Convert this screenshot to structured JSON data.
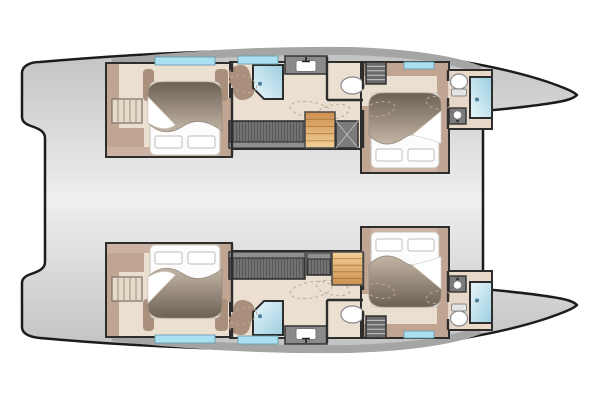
{
  "canvas": {
    "width": 600,
    "height": 400
  },
  "plan": {
    "type": "catamaran-accommodation-plan",
    "bow_direction": "right",
    "hulls": [
      {
        "id": "hull-port",
        "side": "port",
        "mirrored": true
      },
      {
        "id": "hull-starboard",
        "side": "starboard",
        "mirrored": false
      }
    ],
    "summary": {
      "cabins": 4,
      "bathrooms": 4,
      "showers": 4,
      "berths": 4
    },
    "fixtures_shared": [
      {
        "name": "aft-cabin-floor",
        "type": "room",
        "rect": [
          106,
          243,
          126,
          94
        ],
        "fill": "cabin_floor"
      },
      {
        "name": "corridor-floor",
        "type": "room",
        "rect": [
          230,
          251,
          134,
          87
        ],
        "fill": "cabin_floor"
      },
      {
        "name": "forward-cabin-floor",
        "type": "room",
        "rect": [
          361,
          227,
          88,
          111
        ],
        "fill": "cabin_floor"
      },
      {
        "name": "forward-bathroom-floor",
        "type": "room",
        "rect": [
          447,
          271,
          45,
          59
        ],
        "fill": "bath_floor"
      },
      {
        "name": "aft-cabin-wardrobe",
        "type": "band",
        "rect": [
          107,
          244,
          37,
          28
        ],
        "fill": "joinery_taupe"
      },
      {
        "name": "aft-cabin-side-shelf",
        "type": "band",
        "rect": [
          107,
          244,
          12,
          92
        ],
        "fill": "joinery_taupe"
      },
      {
        "name": "aft-cabin-head-strip",
        "type": "band",
        "rect": [
          107,
          244,
          124,
          9
        ],
        "fill": "joinery_taupe_light"
      },
      {
        "name": "aft-cabin-side-right",
        "type": "band",
        "rect": [
          220,
          244,
          11,
          58
        ],
        "fill": "joinery_taupe"
      },
      {
        "name": "aft-bed-flank-left",
        "type": "band",
        "rect": [
          143,
          299,
          11,
          32
        ],
        "fill": "joinery_taupe_dark",
        "rx": 4
      },
      {
        "name": "aft-bed-flank-right",
        "type": "band",
        "rect": [
          215,
          299,
          13,
          32
        ],
        "fill": "joinery_taupe_dark",
        "rx": 4
      },
      {
        "name": "aft-double-berth",
        "type": "bed",
        "rect": [
          150,
          245,
          70,
          73
        ],
        "fold": "left"
      },
      {
        "name": "aft-cabin-ladder",
        "type": "hatch-v",
        "rect": [
          112,
          277,
          30,
          24
        ]
      },
      {
        "name": "hull-settee",
        "type": "stripes",
        "rect": [
          229,
          252,
          76,
          27
        ]
      },
      {
        "name": "mid-shower-partition",
        "type": "wedge",
        "rect": [
          231,
          300,
          21,
          35
        ],
        "rot": 16
      },
      {
        "name": "mid-shower",
        "type": "shower",
        "rect": [
          253,
          301,
          30,
          34
        ],
        "corner": "tl"
      },
      {
        "name": "mid-vanity-sink",
        "type": "sink",
        "rect": [
          285,
          326,
          42,
          18
        ]
      },
      {
        "name": "mid-toilet",
        "type": "toilet",
        "rect": [
          341,
          306,
          23,
          17
        ],
        "orient": "h"
      },
      {
        "name": "forward-cabin-head-strip",
        "type": "band",
        "rect": [
          362,
          228,
          86,
          8
        ],
        "fill": "joinery_taupe_light"
      },
      {
        "name": "forward-cabin-side-left",
        "type": "band",
        "rect": [
          362,
          228,
          9,
          66
        ],
        "fill": "joinery_taupe"
      },
      {
        "name": "forward-cabin-side-right",
        "type": "band",
        "rect": [
          437,
          228,
          11,
          100
        ],
        "fill": "joinery_taupe"
      },
      {
        "name": "forward-cabin-foot-band",
        "type": "band",
        "rect": [
          362,
          324,
          86,
          13
        ],
        "fill": "joinery_taupe"
      },
      {
        "name": "forward-double-berth",
        "type": "bed",
        "rect": [
          371,
          232,
          68,
          75
        ],
        "fold": "right"
      },
      {
        "name": "forward-cabin-shelves",
        "type": "hatch-h",
        "rect": [
          366,
          316,
          20,
          22
        ]
      },
      {
        "name": "forward-sink",
        "type": "sink2",
        "rect": [
          449,
          276,
          17,
          16
        ]
      },
      {
        "name": "forward-toilet",
        "type": "toilet",
        "rect": [
          450,
          304,
          18,
          22
        ],
        "orient": "v"
      },
      {
        "name": "forward-shower",
        "type": "shower",
        "rect": [
          470,
          282,
          22,
          41
        ]
      },
      {
        "name": "hull-window-aft",
        "type": "window",
        "rect": [
          155,
          335,
          60,
          8
        ]
      },
      {
        "name": "hull-window-mid",
        "type": "window",
        "rect": [
          238,
          336,
          40,
          8
        ]
      },
      {
        "name": "hull-window-forward",
        "type": "window",
        "rect": [
          404,
          331,
          30,
          7
        ]
      },
      {
        "name": "wall-aft-cabin",
        "type": "wall",
        "line": [
          232,
          244,
          232,
          312
        ]
      },
      {
        "name": "wall-aft-cabin-stub",
        "type": "wall",
        "line": [
          232,
          328,
          232,
          337
        ]
      },
      {
        "name": "wall-toilet-left",
        "type": "wall",
        "line": [
          327,
          300,
          327,
          343
        ]
      },
      {
        "name": "wall-toilet-top",
        "type": "wall",
        "line": [
          327,
          300,
          363,
          300
        ]
      },
      {
        "name": "wall-fwd-cabin-aft-1",
        "type": "wall",
        "line": [
          363,
          252,
          363,
          290
        ]
      },
      {
        "name": "wall-fwd-cabin-aft-2",
        "type": "wall",
        "line": [
          363,
          311,
          363,
          337
        ]
      },
      {
        "name": "wall-fwd-cabin-fwd-1",
        "type": "wall",
        "line": [
          448,
          271,
          448,
          302
        ]
      },
      {
        "name": "wall-fwd-cabin-fwd-2",
        "type": "wall",
        "line": [
          448,
          319,
          448,
          330
        ]
      },
      {
        "name": "door-swing-aft-cabin",
        "type": "arc",
        "ell": [
          243,
          316,
          14,
          8,
          -18
        ]
      },
      {
        "name": "door-swing-corridor-a",
        "type": "arc",
        "ell": [
          311,
          290,
          21,
          8,
          -10
        ]
      },
      {
        "name": "door-swing-corridor-b",
        "type": "arc",
        "ell": [
          333,
          288,
          17,
          7,
          12
        ]
      },
      {
        "name": "door-swing-fwd-cabin",
        "type": "arc",
        "ell": [
          380,
          291,
          15,
          7,
          10
        ]
      },
      {
        "name": "door-swing-fwd-bath",
        "type": "arc",
        "ell": [
          438,
          297,
          12,
          6,
          -12
        ]
      }
    ],
    "fixtures_starboard": [
      {
        "name": "hull-locker",
        "type": "stripes",
        "rect": [
          307,
          253,
          24,
          22
        ]
      },
      {
        "name": "companionway-steps",
        "type": "steps",
        "rect": [
          332,
          252,
          31,
          33
        ]
      }
    ],
    "fixtures_port": [
      {
        "name": "companionway-steps",
        "type": "steps",
        "rect": [
          305,
          252,
          30,
          36
        ]
      },
      {
        "name": "technical-hatch",
        "type": "xbox",
        "rect": [
          336,
          252,
          22,
          27
        ]
      }
    ]
  },
  "palette": {
    "background": "#ffffff",
    "outline": "#1c1c1c",
    "deck_edge": "#c2c2c2",
    "deck_center": "#efefef",
    "cabin_floor": "#eadfd1",
    "bath_floor": "#e7d8ca",
    "joinery_taupe": "#c1a593",
    "joinery_taupe_light": "#cbb2a2",
    "joinery_taupe_dark": "#ab8f7d",
    "bedding_white": "#fcfcfc",
    "duvet_light": "#c3b5a6",
    "duvet_dark": "#6c6053",
    "shower_light": "#e8f6fa",
    "shower_dark": "#9ccee0",
    "hull_window_blue": "#abe0f1",
    "window_frame": "#6d9fb0",
    "settee_gray": "#575757",
    "settee_back": "#8f8f8f",
    "settee_stripe": "#9b9b9b",
    "steps_wood_light": "#f3cf96",
    "steps_wood_dark": "#cd8f4e",
    "wall_outline": "#2d2d2d",
    "fixture_white": "#ffffff",
    "fixture_stroke": "#8a8a8a",
    "door_swing": "#bcaa97",
    "window_band": "#a5a5a5",
    "hatch_dark": "#6b6b6b",
    "tech_gray": "#7b7b7b"
  }
}
